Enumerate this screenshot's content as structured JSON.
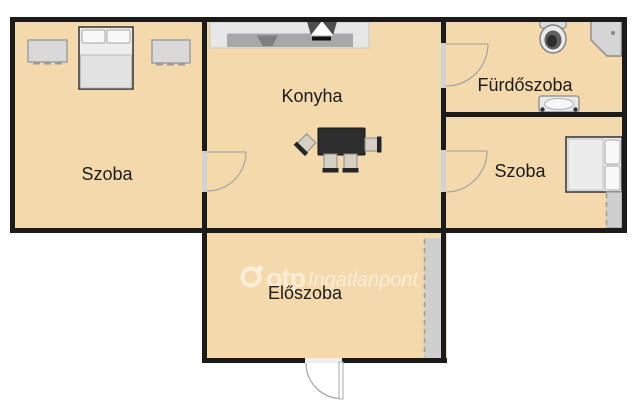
{
  "plan": {
    "type": "apartment-floor-plan",
    "language": "hu",
    "rooms": {
      "szoba_left": {
        "label": "Szoba",
        "furniture": [
          "double-bed",
          "dresser",
          "dresser"
        ]
      },
      "konyha": {
        "label": "Konyha",
        "furniture": [
          "kitchen-counter",
          "kitchen-sink",
          "cooker-hood",
          "dining-table",
          "chair",
          "chair",
          "chair",
          "chair"
        ]
      },
      "furdoszoba": {
        "label": "Fürdőszoba",
        "furniture": [
          "toilet",
          "corner-shower",
          "washbasin"
        ]
      },
      "szoba_right": {
        "label": "Szoba",
        "furniture": [
          "double-bed",
          "wardrobe"
        ]
      },
      "eloszoba": {
        "label": "Előszoba",
        "furniture": [
          "wardrobe"
        ]
      }
    },
    "doors": [
      "szoba-left-to-konyha",
      "konyha-to-furdoszoba",
      "konyha-to-szoba-right",
      "entrance-door"
    ],
    "watermark": {
      "logo_icon": "otp-ring-logo",
      "brand": "otp",
      "suffix": "Ingatlanpont"
    },
    "colors": {
      "background": "#ffffff",
      "floor": "#f3d9ac",
      "wall": "#1b1b1b",
      "furniture_light": "#e9e9e9",
      "furniture_dark": "#2d2d2d",
      "cabinet_gray": "#cfcfcf",
      "watermark": "rgba(255,255,255,0.55)"
    }
  }
}
